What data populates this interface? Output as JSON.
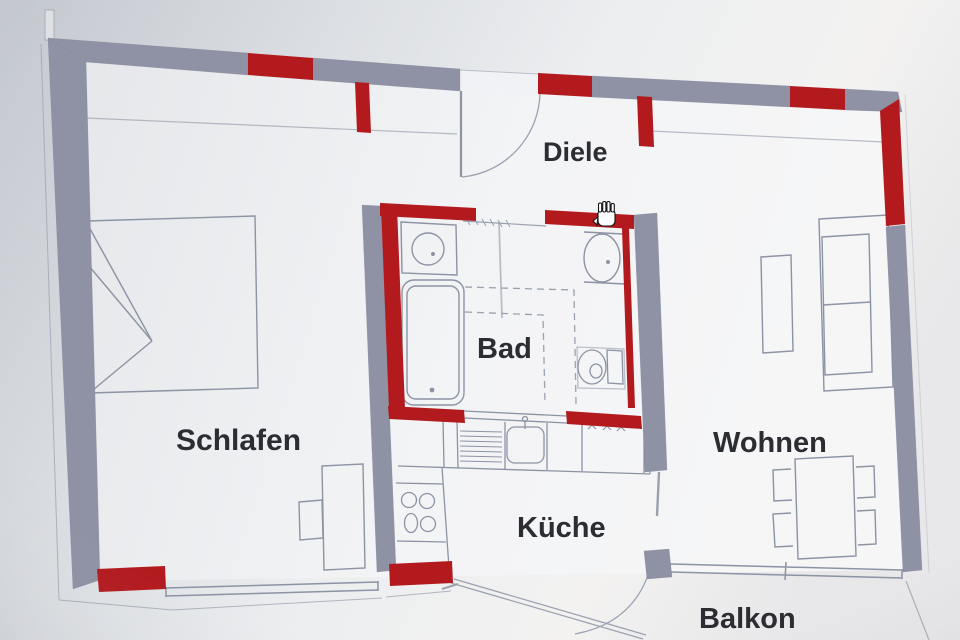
{
  "floorplan": {
    "title": "apartment floor plan",
    "rooms": [
      {
        "id": "schlafen",
        "label": "Schlafen"
      },
      {
        "id": "diele",
        "label": "Diele"
      },
      {
        "id": "bad",
        "label": "Bad"
      },
      {
        "id": "kueche",
        "label": "Küche"
      },
      {
        "id": "wohnen",
        "label": "Wohnen"
      },
      {
        "id": "balkon",
        "label": "Balkon"
      }
    ],
    "colors": {
      "paper": "#d3d6da",
      "interior": "#f3f4f6",
      "wall_gray": "#8f92a6",
      "wall_red": "#b8181c",
      "line": "#8b93a5",
      "text": "#2b2c31"
    },
    "cursor": "hand-cursor"
  }
}
